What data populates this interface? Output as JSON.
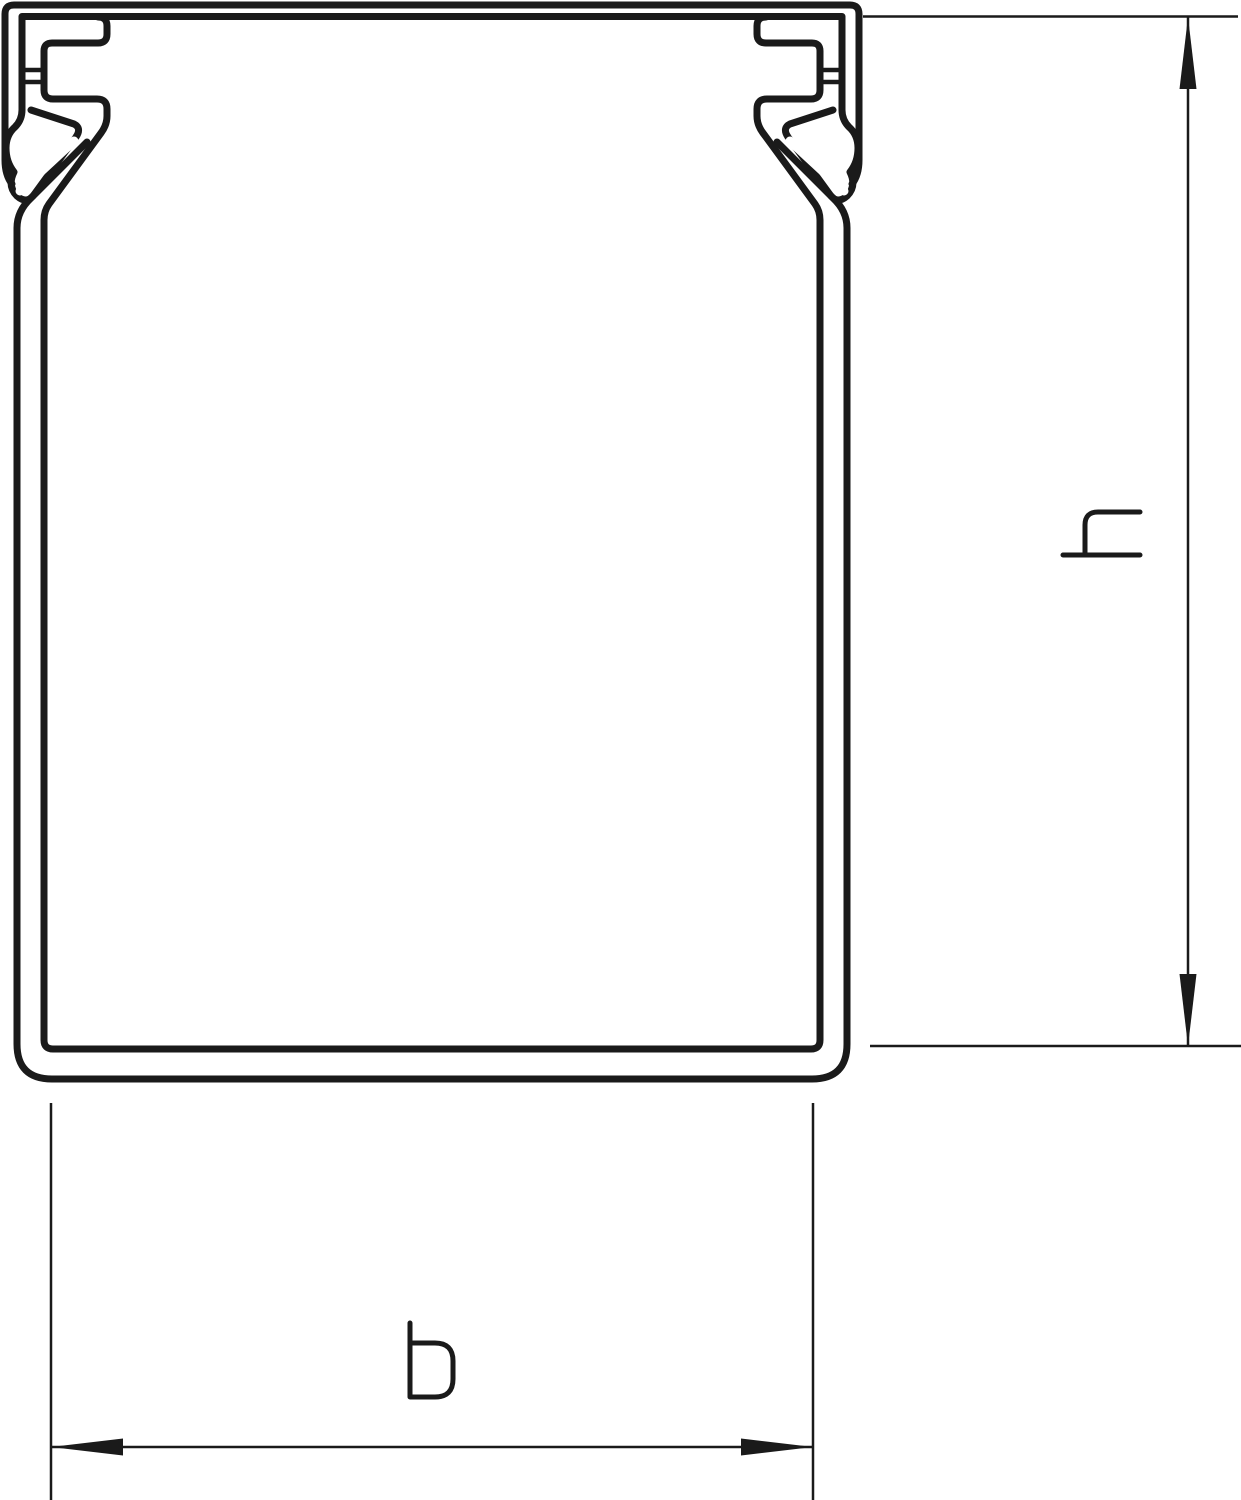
{
  "canvas": {
    "width": 1241,
    "height": 1500,
    "background": "#ffffff",
    "stroke_color": "#1a1a1a"
  },
  "drawing": {
    "kind": "technical line drawing",
    "subject": "cable duct profile cross-section with snap-in cover hooks"
  },
  "dimension_h": {
    "label": "h",
    "orientation": "vertical",
    "side": "right",
    "arrows": "outward filled, pointing up and down"
  },
  "dimension_b": {
    "label": "b",
    "orientation": "horizontal",
    "side": "bottom",
    "arrows": "outward filled, pointing left and right"
  }
}
